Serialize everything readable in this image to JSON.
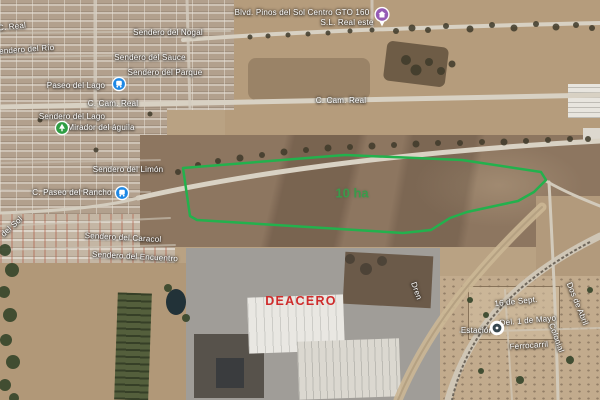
{
  "map": {
    "view_type": "satellite",
    "parcel": {
      "area_label": "10 ha",
      "outline_color": "#23b14d",
      "points": "183,168 345,155 462,160 541,172 546,180 534,192 518,201 467,212 450,218 431,230 403,233 197,220 190,216"
    },
    "site_label": {
      "text": "DEACERO",
      "color": "#cf2b2b"
    },
    "labels": [
      {
        "text": "C. Real"
      },
      {
        "text": "Sendero del Río"
      },
      {
        "text": "Paseo del Lago"
      },
      {
        "text": "Sendero del Nogal"
      },
      {
        "text": "Sendero del Sauce"
      },
      {
        "text": "Sendero del Parque"
      },
      {
        "text": "Blvd. Pinos del Sol Centro GTO 160"
      },
      {
        "text": "S.L. Real este"
      },
      {
        "text": "C. Cam. Real"
      },
      {
        "text": "C. Cam. Real"
      },
      {
        "text": "Sendero del Lago"
      },
      {
        "text": "Mirador del águila"
      },
      {
        "text": "Sendero del Limón"
      },
      {
        "text": "C. Paseo del Rancho"
      },
      {
        "text": "del Sol"
      },
      {
        "text": "Sendero del Caracol"
      },
      {
        "text": "Sendero del Encuentro"
      },
      {
        "text": "Dren"
      },
      {
        "text": "16 de Sept."
      },
      {
        "text": "Dos de Abril"
      },
      {
        "text": "Del. 1 de Mayo"
      },
      {
        "text": "Estación"
      },
      {
        "text": "Ferrocarril"
      },
      {
        "text": "Colonial"
      }
    ],
    "markers": [
      {
        "name": "lodging-pin",
        "color": "#955bb5"
      },
      {
        "name": "poi-marker-blue",
        "color": "#1e88e5"
      },
      {
        "name": "park-marker",
        "color": "#2f9e44"
      },
      {
        "name": "bus-stop-marker",
        "color": "#1e88e5"
      },
      {
        "name": "station-marker",
        "color": "#37474f"
      }
    ]
  }
}
